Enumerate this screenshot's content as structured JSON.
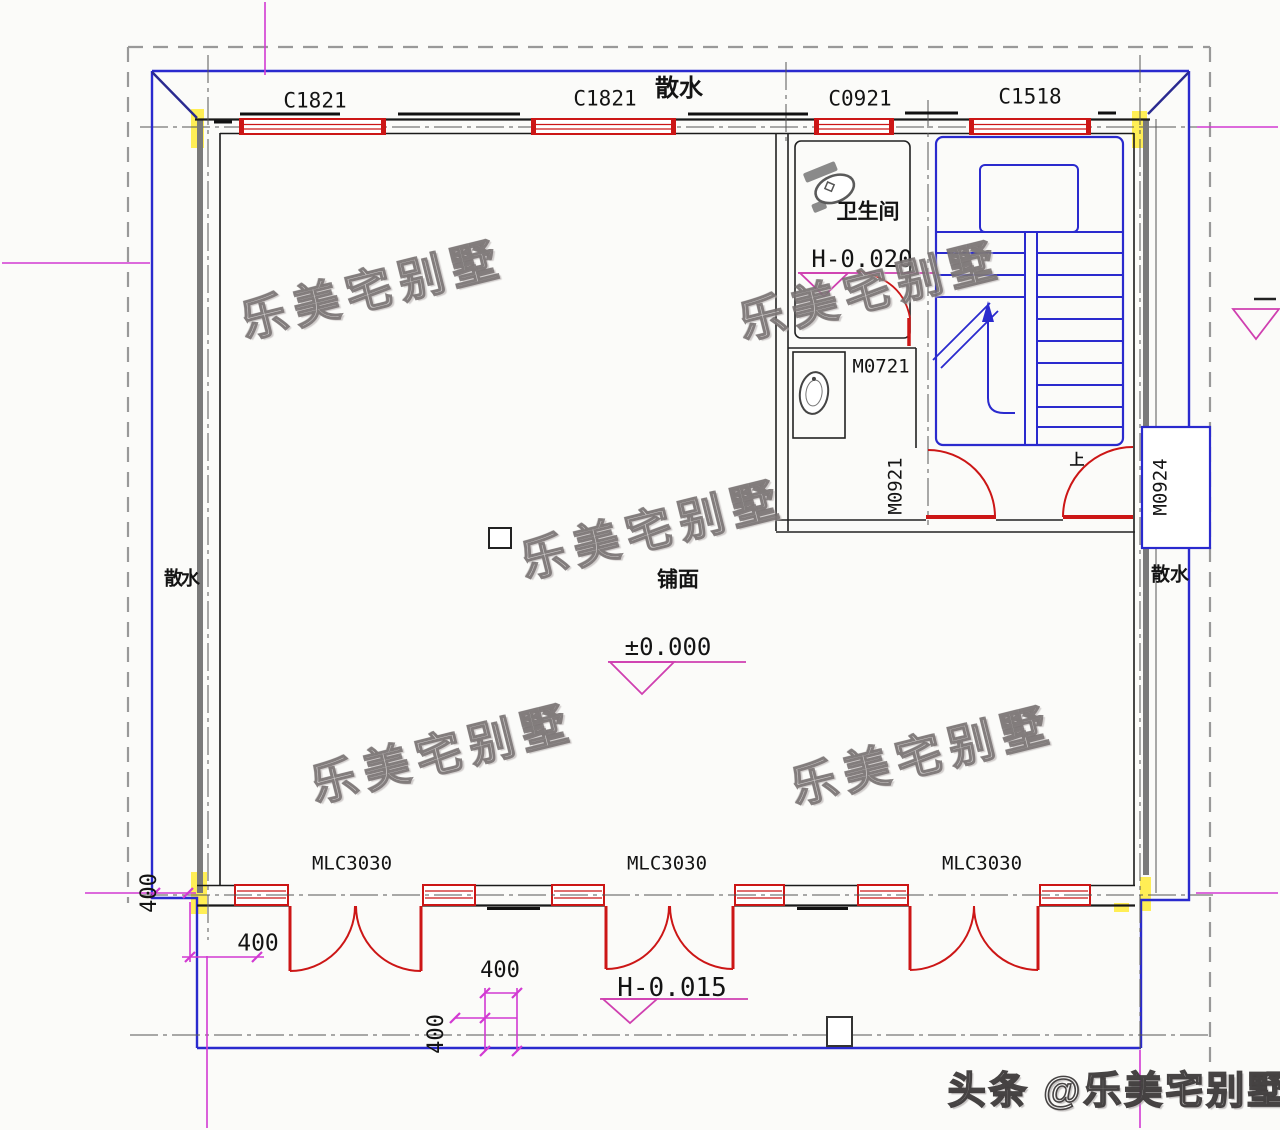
{
  "windows": {
    "c1821_left": "C1821",
    "c1821_mid": "C1821",
    "c0921": "C0921",
    "c1518": "C1518"
  },
  "doors": {
    "m0721": "M0721",
    "m0921": "M0921",
    "m0924": "M0924",
    "mlc_left": "MLC3030",
    "mlc_mid": "MLC3030",
    "mlc_right": "MLC3030"
  },
  "rooms": {
    "bathroom": "卫生间",
    "shop": "铺面"
  },
  "elevations": {
    "bathroom": "H-0.020",
    "shop": "±0.000",
    "outside": "H-0.015"
  },
  "apron": {
    "top": "散水",
    "left": "散水",
    "right": "散水"
  },
  "stairs": {
    "up": "上"
  },
  "dims": {
    "left_vertical": "400",
    "left_horizontal": "400",
    "bottom_horizontal": "400",
    "bottom_vertical": "400"
  },
  "watermark": {
    "text": "乐美宅别墅",
    "credit": "头条 @乐美宅别墅"
  },
  "colors": {
    "wall": "#1a1a1a",
    "window_red": "#cc1616",
    "stair_blue": "#2a2ace",
    "axis_magenta": "#d23ad2",
    "elevation_pink": "#cf3fb0",
    "column_yellow": "#ffee55",
    "boundary_gray": "#999999",
    "wall_face_gray": "#7a7a7a"
  }
}
